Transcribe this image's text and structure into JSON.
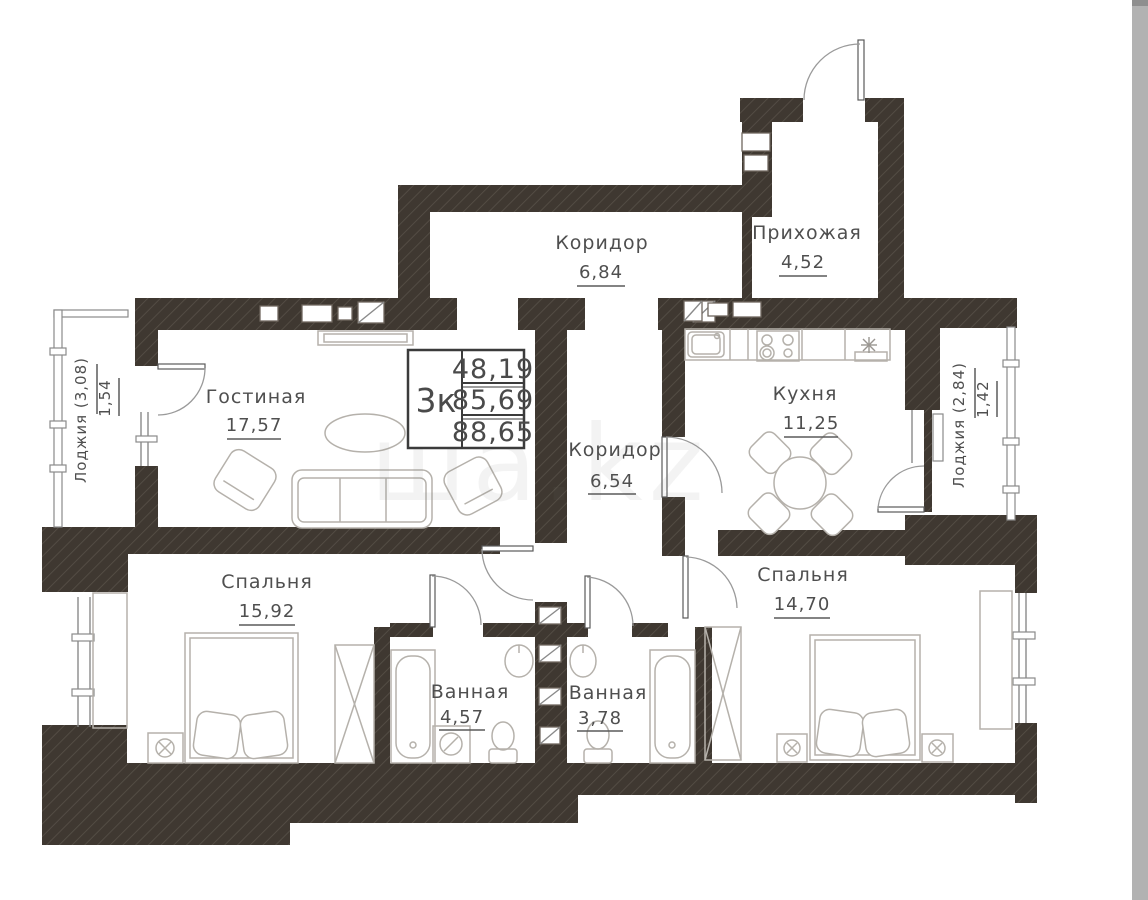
{
  "plan": {
    "unit_table": {
      "type_label": "3к",
      "rows": [
        "48,19",
        "85,69",
        "88,65"
      ]
    },
    "rooms": [
      {
        "id": "hallway",
        "name": "Прихожая",
        "area": "4,52"
      },
      {
        "id": "corridor-top",
        "name": "Коридор",
        "area": "6,84"
      },
      {
        "id": "living-room",
        "name": "Гостиная",
        "area": "17,57"
      },
      {
        "id": "kitchen",
        "name": "Кухня",
        "area": "11,25"
      },
      {
        "id": "corridor-mid",
        "name": "Коридор",
        "area": "6,54"
      },
      {
        "id": "bedroom-left",
        "name": "Спальня",
        "area": "15,92"
      },
      {
        "id": "bedroom-right",
        "name": "Спальня",
        "area": "14,70"
      },
      {
        "id": "bathroom-left",
        "name": "Ванная",
        "area": "4,57"
      },
      {
        "id": "bathroom-right",
        "name": "Ванная",
        "area": "3,78"
      },
      {
        "id": "loggia-left",
        "name": "Лоджия (3,08)",
        "area": "1,54"
      },
      {
        "id": "loggia-right",
        "name": "Лоджия (2,84)",
        "area": "1,42"
      }
    ],
    "watermark": "ша.kz",
    "colors": {
      "wall": "#3f3831",
      "text": "#4f4f4f",
      "furniture": "#b5b1ab",
      "scrollbar": "#b2b2b2"
    }
  }
}
